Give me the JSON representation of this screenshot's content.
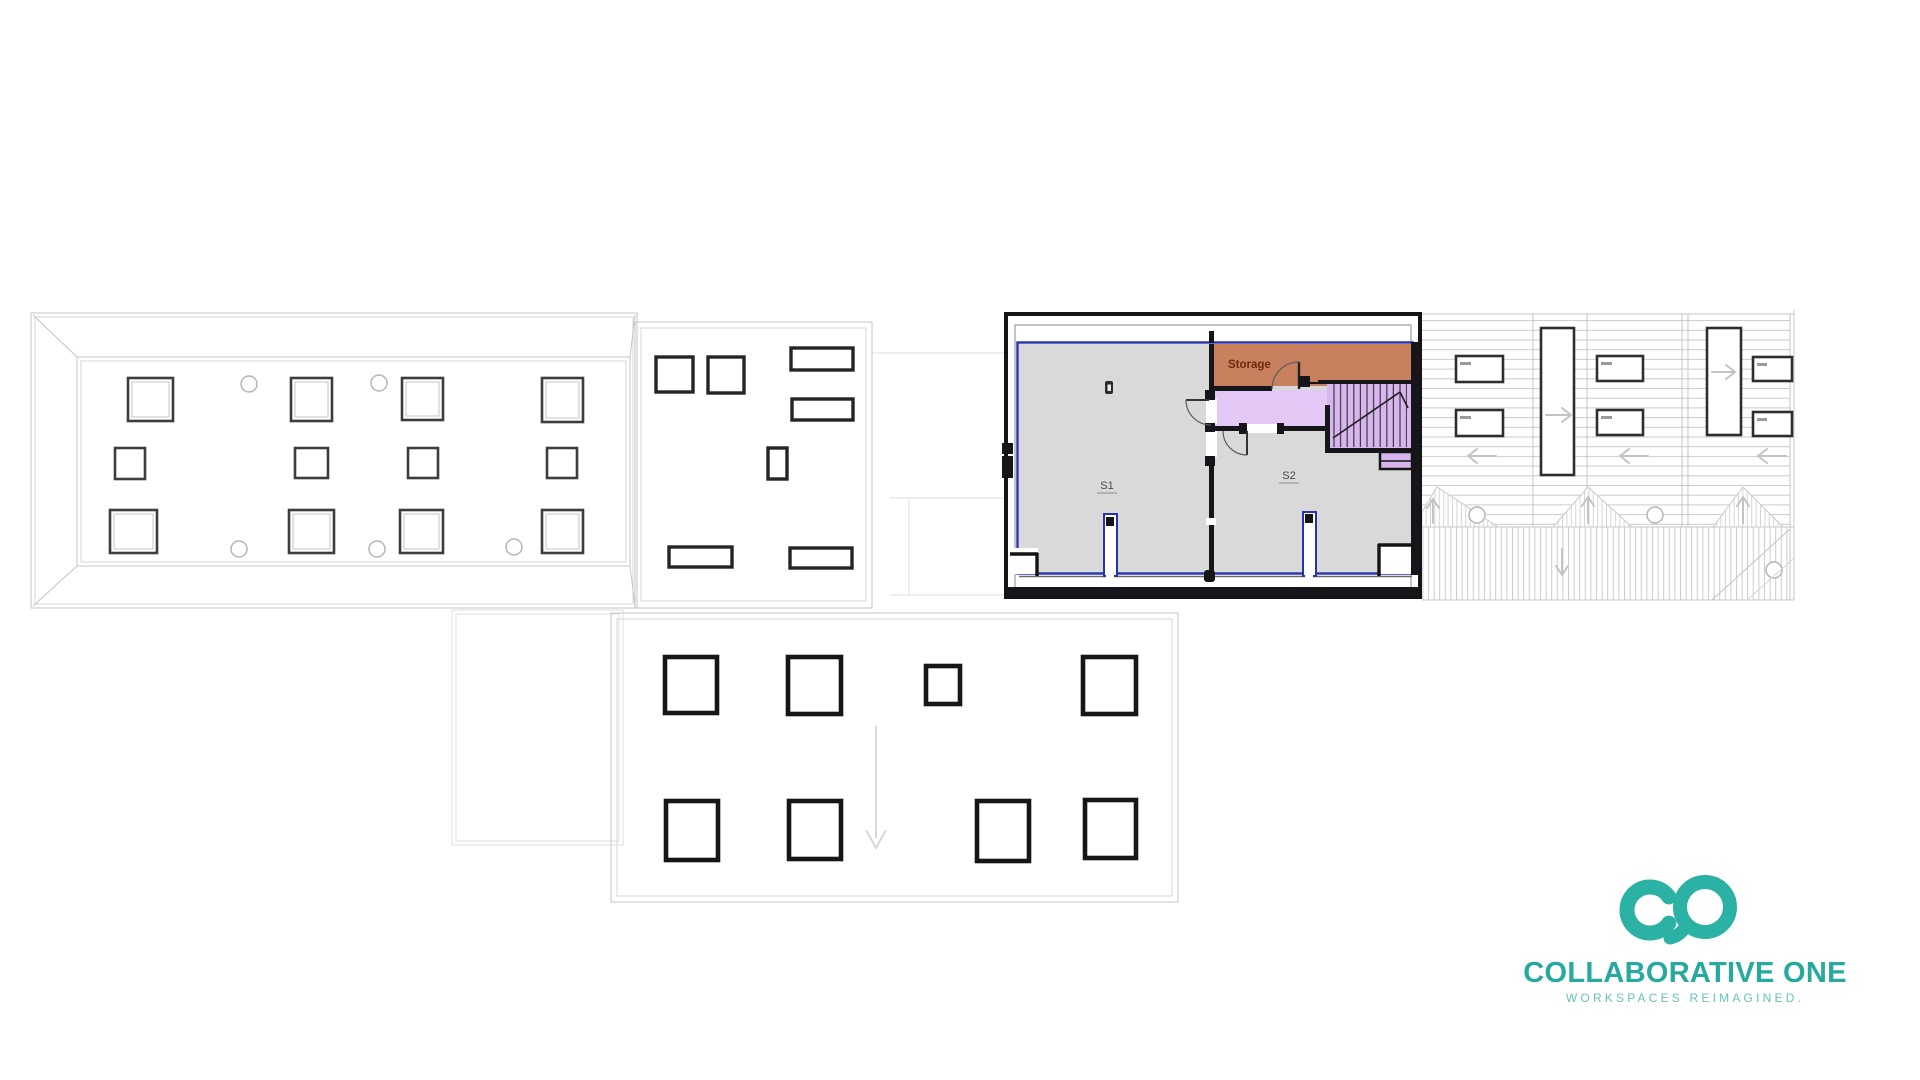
{
  "meta": {
    "kind": "architectural-floor-plan-sheet"
  },
  "colors": {
    "ink": "#15151a",
    "line": "#c4c4c4",
    "line-faint": "#dfdfdf",
    "sq-dark": "#3d3d3d",
    "unit-blue": "#2634ab",
    "unit-gray": "#d9d9d9",
    "storage-fill": "#c8805f",
    "storage-text": "#6d2a10",
    "lavender": "#e4c9f6",
    "lavender-deep": "#d8b5ef",
    "hatch": "#cbcbcb",
    "teal": "#2cb1a5",
    "teal-dark": "#28a99e",
    "teal-soft": "#67c2b8"
  },
  "unit_plan": {
    "storage_label": "Storage",
    "room1_label": "S1",
    "room2_label": "S2"
  },
  "logo": {
    "title": "COLLABORATIVE ONE",
    "tagline": "WORKSPACES REIMAGINED."
  }
}
